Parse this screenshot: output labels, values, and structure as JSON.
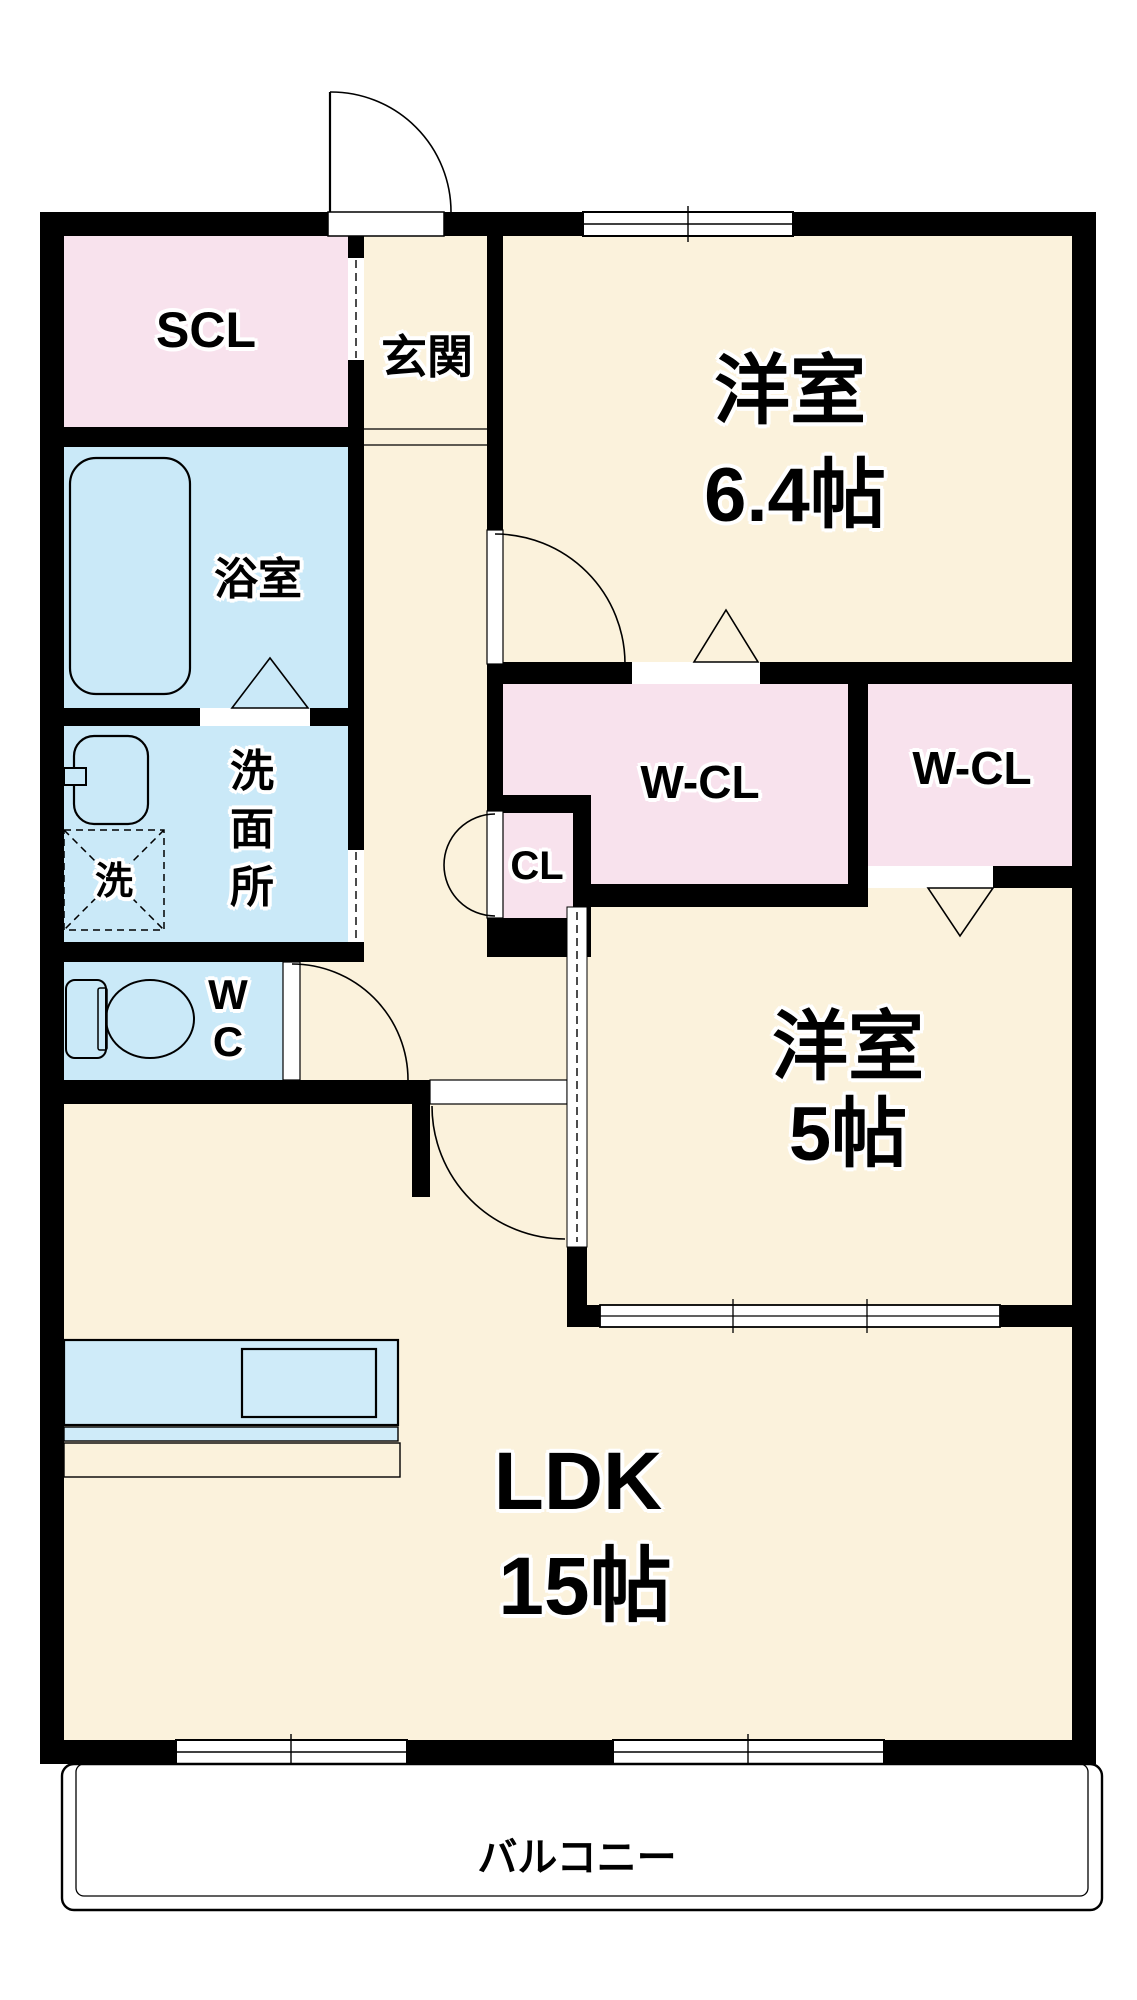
{
  "rooms": {
    "scl": "SCL",
    "genkan": "玄関",
    "bedroom1": "洋室",
    "bedroom1_size": "6.4帖",
    "bathroom": "浴室",
    "washroom_char1": "洗",
    "washroom_char2": "面",
    "washroom_char3": "所",
    "laundry": "洗",
    "wc_char1": "W",
    "wc_char2": "C",
    "closet": "CL",
    "walkin_closet_left": "W-CL",
    "walkin_closet_right": "W-CL",
    "bedroom2": "洋室",
    "bedroom2_size": "5帖",
    "ldk": "LDK",
    "ldk_size": "15帖",
    "balcony": "バルコニー"
  },
  "colors": {
    "wall": "#000000",
    "room_floor": "#FBF2DC",
    "closet_floor": "#F8E2ED",
    "wet_area_floor": "#CAE9F8",
    "kitchen_counter": "#CFEBF9",
    "balcony": "#FFFFFF",
    "outline": "#000000"
  }
}
